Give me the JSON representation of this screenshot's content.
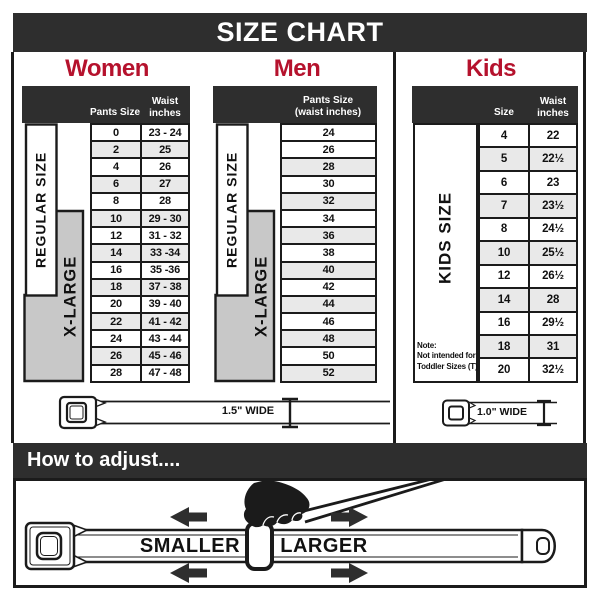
{
  "title": "SIZE CHART",
  "colors": {
    "dark_bar": "#2e2e2e",
    "heading_red": "#b5122d",
    "row_shade": "#e9e9e9",
    "label_gray": "#c8c8c8",
    "line": "#1b1b1b"
  },
  "women": {
    "heading": "Women",
    "col1_header": "Pants Size",
    "waist_header": [
      "Waist",
      "inches"
    ],
    "regular_label": "REGULAR SIZE",
    "xlarge_label": "X-LARGE",
    "rows": [
      {
        "size": "0",
        "waist": "23 - 24"
      },
      {
        "size": "2",
        "waist": "25"
      },
      {
        "size": "4",
        "waist": "26"
      },
      {
        "size": "6",
        "waist": "27"
      },
      {
        "size": "8",
        "waist": "28"
      },
      {
        "size": "10",
        "waist": "29 - 30"
      },
      {
        "size": "12",
        "waist": "31 - 32"
      },
      {
        "size": "14",
        "waist": "33 -34"
      },
      {
        "size": "16",
        "waist": "35 -36"
      },
      {
        "size": "18",
        "waist": "37 - 38"
      },
      {
        "size": "20",
        "waist": "39 - 40"
      },
      {
        "size": "22",
        "waist": "41 - 42"
      },
      {
        "size": "24",
        "waist": "43 - 44"
      },
      {
        "size": "26",
        "waist": "45 - 46"
      },
      {
        "size": "28",
        "waist": "47 - 48"
      }
    ]
  },
  "men": {
    "heading": "Men",
    "header_lines": [
      "Pants Size",
      "(waist inches)"
    ],
    "regular_label": "REGULAR SIZE",
    "xlarge_label": "X-LARGE",
    "rows": [
      "24",
      "26",
      "28",
      "30",
      "32",
      "34",
      "36",
      "38",
      "40",
      "42",
      "44",
      "46",
      "48",
      "50",
      "52"
    ]
  },
  "kids": {
    "heading": "Kids",
    "col1_header": "Size",
    "waist_header": [
      "Waist",
      "inches"
    ],
    "label": "KIDS SIZE",
    "note_lines": [
      "Note:",
      "Not intended for",
      "Toddler Sizes (T)"
    ],
    "rows": [
      {
        "size": "4",
        "waist": "22"
      },
      {
        "size": "5",
        "waist": "22½"
      },
      {
        "size": "6",
        "waist": "23"
      },
      {
        "size": "7",
        "waist": "23½"
      },
      {
        "size": "8",
        "waist": "24½"
      },
      {
        "size": "10",
        "waist": "25½"
      },
      {
        "size": "12",
        "waist": "26½"
      },
      {
        "size": "14",
        "waist": "28"
      },
      {
        "size": "16",
        "waist": "29½"
      },
      {
        "size": "18",
        "waist": "31"
      },
      {
        "size": "20",
        "waist": "32½"
      }
    ]
  },
  "belts": {
    "adult_width": "1.5\" WIDE",
    "kids_width": "1.0\" WIDE"
  },
  "adjust": {
    "bar_label": "How to adjust....",
    "smaller": "SMALLER",
    "larger": "LARGER"
  }
}
